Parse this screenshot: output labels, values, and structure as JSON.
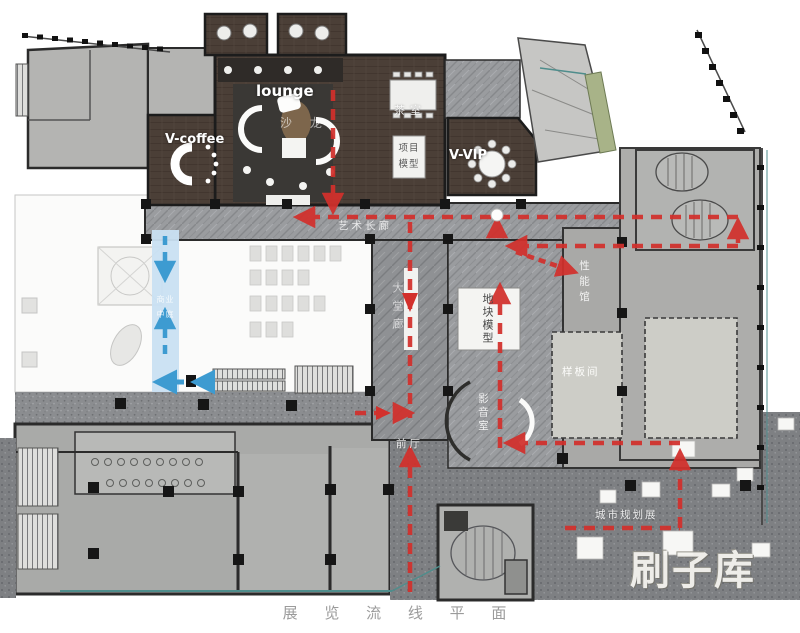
{
  "title": "展 览 流 线 平 面",
  "watermark": "刷子库",
  "colors": {
    "route_red": "#d2302c",
    "route_blue": "#3d9bd1",
    "atrium_blue": "#c9e0f2",
    "boundary_teal": "#4f8d8c",
    "wood_floor": "#4b3f37",
    "green_strip": "#a8b388"
  },
  "rooms": {
    "lounge": "lounge",
    "salon": "沙 龙",
    "tea_room": "茶室",
    "v_coffee": "V-coffee",
    "project_model_l1": "项目",
    "project_model_l2": "模型",
    "v_vip": "V-VIP",
    "art_gallery": "艺术长廊",
    "lobby_corridor": "大堂廊",
    "site_model": "地块模型",
    "performance_hall": "性能馆",
    "sample_room": "样板间",
    "av_room": "影音室",
    "front_hall": "前厅",
    "city_planning": "城市规划展",
    "atrium_l1": "商业",
    "atrium_l2": "中庭"
  },
  "legend": {
    "red_route": "exhibition-circulation",
    "blue_route": "mall-vertical-circulation"
  }
}
